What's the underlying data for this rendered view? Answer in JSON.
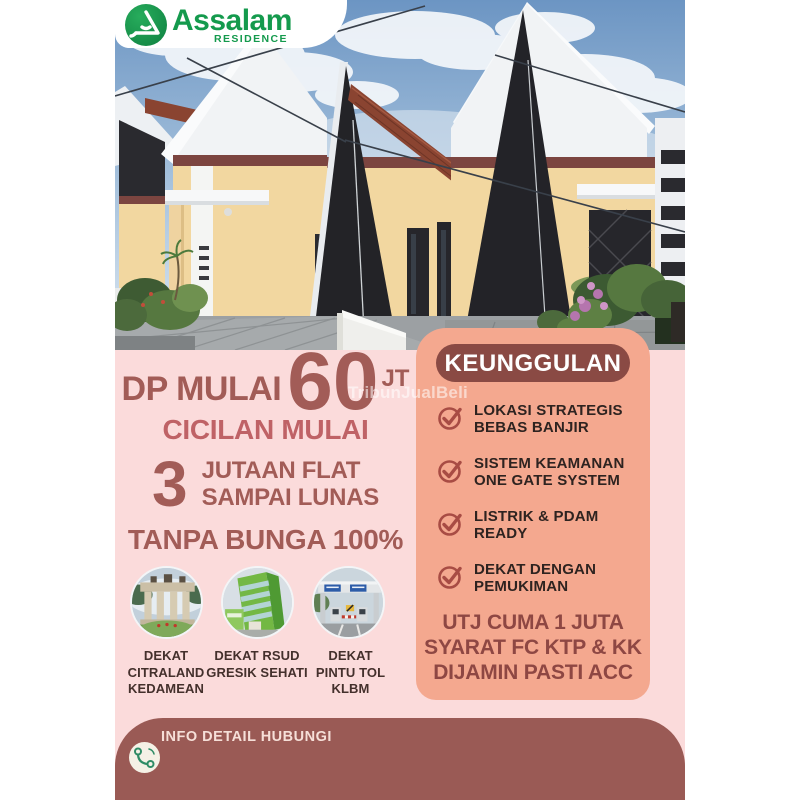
{
  "colors": {
    "pink_bg": "#FBDBDB",
    "salmon_panel": "#F4A88F",
    "maroon_pill": "#8A4A44",
    "footer_bar": "#9A5A55",
    "headline_text": "#A25C57",
    "installment_label_text": "#BF6266",
    "promo_text": "#8E4743",
    "body_text": "#2E2320",
    "caption_text": "#44302C",
    "logo_green": "#149A4D",
    "check_icon": "#A84C44",
    "phone_icon_green": "#2F8C66"
  },
  "logo": {
    "brand": "Assalam",
    "subtitle": "RESIDENCE",
    "mark": "assalam-leaf-mark"
  },
  "offer": {
    "dp_label": "DP MULAI",
    "dp_value": "60",
    "dp_unit": "JT",
    "installment_label": "CICILAN MULAI",
    "installment_value": "3",
    "installment_desc_line1": "JUTAAN FLAT",
    "installment_desc_line2": "SAMPAI LUNAS",
    "interest_note": "TANPA BUNGA 100%"
  },
  "nearby": [
    {
      "icon": "citraland-gate-photo",
      "line1": "DEKAT",
      "line2": "CITRALAND",
      "line3": "KEDAMEAN"
    },
    {
      "icon": "rsud-hospital-photo",
      "line1": "DEKAT RSUD",
      "line2": "GRESIK SEHATI",
      "line3": ""
    },
    {
      "icon": "toll-gate-photo",
      "line1": "DEKAT",
      "line2": "PINTU TOL",
      "line3": "KLBM"
    }
  ],
  "advantages": {
    "title": "KEUNGGULAN",
    "items": [
      {
        "line1": "LOKASI STRATEGIS",
        "line2": "BEBAS BANJIR"
      },
      {
        "line1": "SISTEM KEAMANAN",
        "line2": "ONE GATE SYSTEM"
      },
      {
        "line1": "LISTRIK & PDAM",
        "line2": "READY"
      },
      {
        "line1": "DEKAT DENGAN",
        "line2": "PEMUKIMAN"
      }
    ],
    "promo_line1": "UTJ CUMA 1 JUTA",
    "promo_line2": "SYARAT FC KTP & KK",
    "promo_line3": "DIJAMIN PASTI ACC"
  },
  "footer": {
    "label": "INFO DETAIL HUBUNGI"
  },
  "watermark": "TribunJualBeli"
}
